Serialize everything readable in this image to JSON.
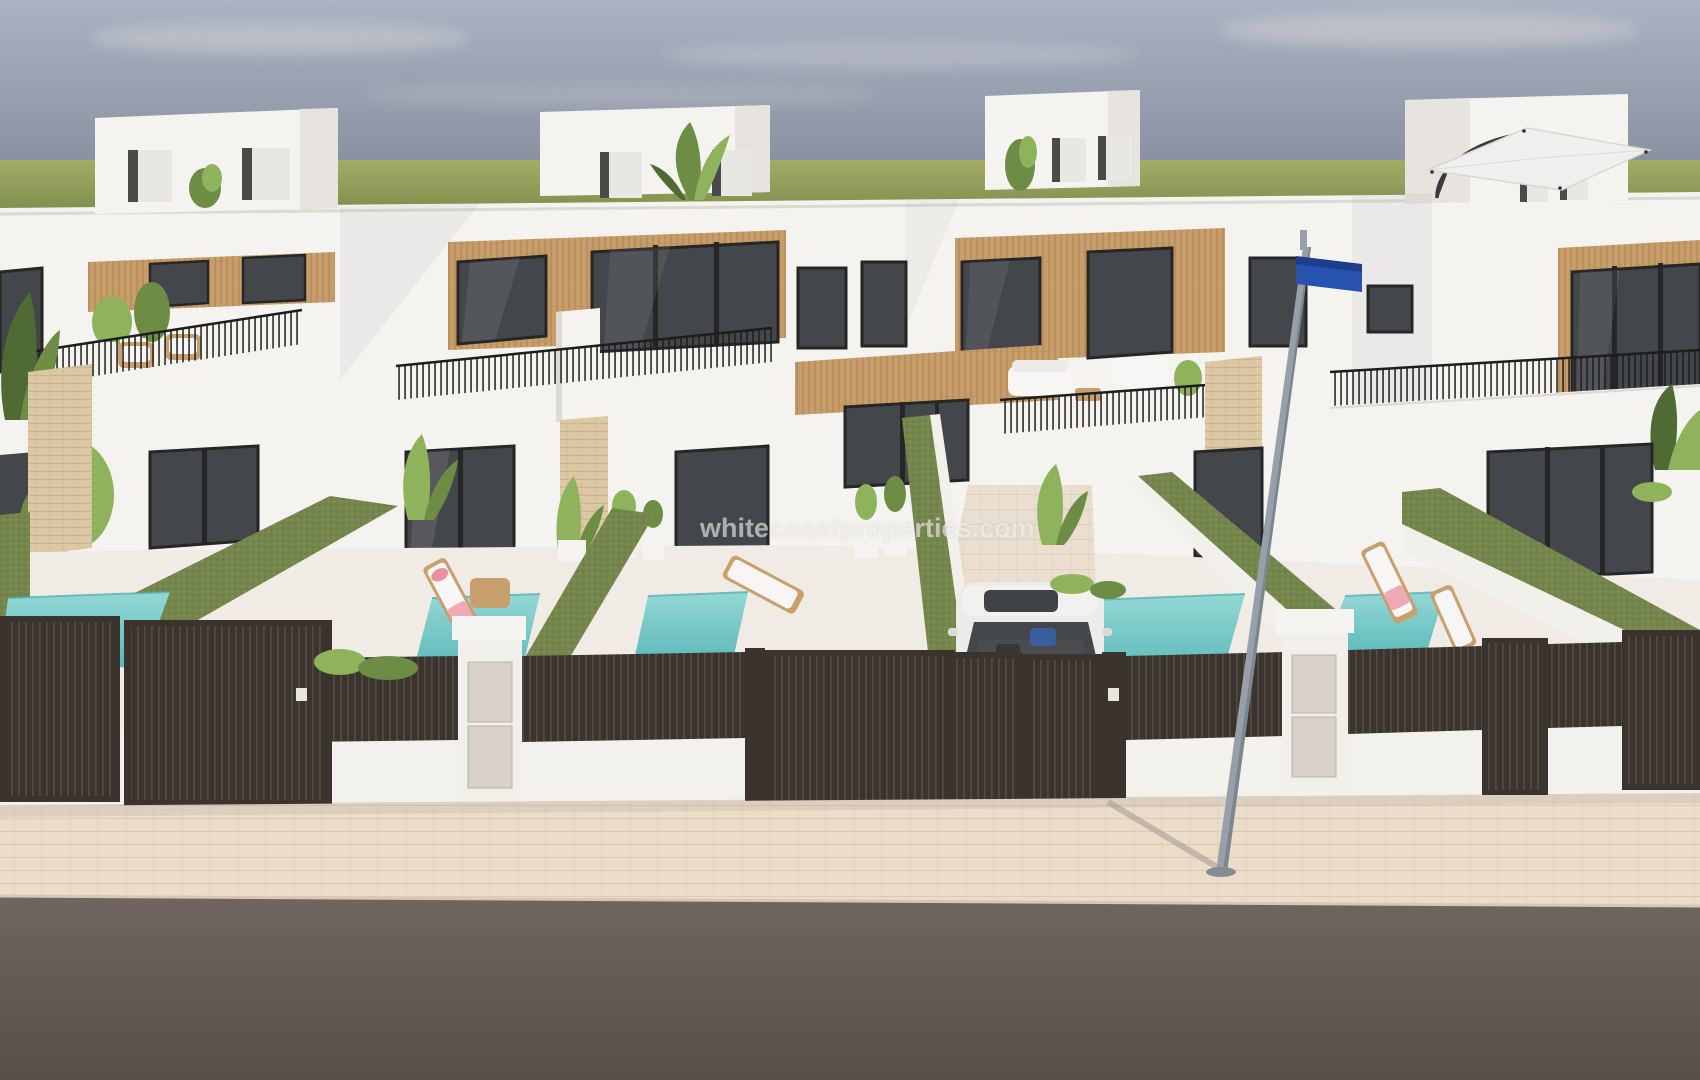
{
  "watermark": {
    "text": "whitecoastproperties.com"
  },
  "scene": {
    "type": "architectural-render",
    "subject": "row of modern white new-build townhouses with wood-slat accents, private plunge pools, dark slatted entrance gates, sidewalk and street",
    "houses_visible": 5,
    "pools_visible": 5,
    "vehicles": [
      "white-car"
    ],
    "street_furniture": [
      "street-lamp-post",
      "blue-street-sign"
    ],
    "rooftop_items": [
      "roof-access-boxes",
      "cantilever-umbrella",
      "potted-plants"
    ]
  },
  "palette": {
    "sky_top": "#aab3c2",
    "sky_mid": "#939baa",
    "sky_low": "#7d8598",
    "grass_hi": "#a2ac67",
    "grass_lo": "#7f8e4c",
    "wall": "#f4f3f0",
    "wall_shade": "#e7e4df",
    "wall_shade2": "#d9d5cf",
    "wood": "#c79e6b",
    "wood_line": "#a87a45",
    "glass": "#43464a",
    "glass_hi": "#6a6e72",
    "frame": "#262626",
    "rail": "#1d1d1d",
    "stone": "#dcc8a5",
    "stone_line": "#c3aa82",
    "hedge": "#75864d",
    "hedge_hi": "#8d9c63",
    "pool": "#93d8d5",
    "pool_deep": "#5cb9b9",
    "fence": "#3a332e",
    "fence_hi": "#5c5248",
    "pillar": "#f1efe9",
    "panel": "#d8d2c9",
    "pave": "#ecdcca",
    "pave_line": "#d9c6b0",
    "road": "#6e665f",
    "road_low": "#574f49",
    "car": "#edebe9",
    "pole": "#97a0aa",
    "sign": "#2753ae",
    "sign_dark": "#1c3e8d",
    "plant": "#6d8c44",
    "plant_hi": "#8fb35c",
    "plant_dark": "#4f6a33",
    "towel": "#f0a9b4",
    "tan": "#c8a06e",
    "white": "#f7f6f4",
    "watermark": "rgba(255,255,255,0.55)"
  }
}
